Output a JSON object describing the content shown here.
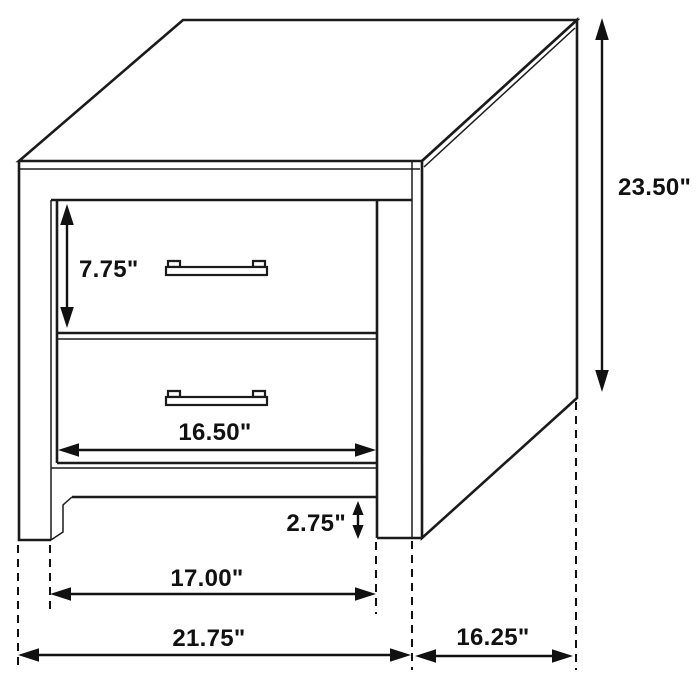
{
  "diagram": {
    "title": "Two-drawer nightstand dimension diagram",
    "product": "2-drawer nightstand",
    "style": "black line art on white",
    "units": "inches",
    "colors": {
      "line": "#1b1b1b",
      "annotation": "#111111",
      "background": "#ffffff"
    },
    "features": {
      "drawer_count": 2,
      "handle_type": "bar pull",
      "view": "three-quarter isometric front-right"
    },
    "labels": {
      "overall_height": "23.50\"",
      "drawer_face_height": "7.75\"",
      "drawer_width": "16.50\"",
      "leg_height": "2.75\"",
      "base_width": "17.00\"",
      "overall_width": "21.75\"",
      "overall_depth": "16.25\""
    },
    "values_in": {
      "overall_height": 23.5,
      "drawer_face_height": 7.75,
      "drawer_width": 16.5,
      "leg_height": 2.75,
      "base_width": 17.0,
      "overall_width": 21.75,
      "overall_depth": 16.25
    }
  }
}
